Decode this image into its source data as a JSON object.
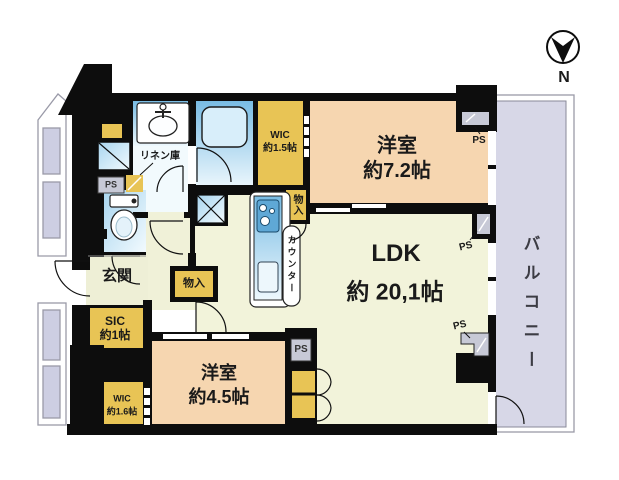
{
  "palette": {
    "wall": "#0d0d0d",
    "room_peach": "#f6d6b0",
    "floor_yellow_green": "#f2f3da",
    "closet_yellow": "#e8c455",
    "water_blue": "#79bce4",
    "balcony_lavender": "#d7d7e7",
    "ps_grey": "#c7c9d6"
  },
  "compass": {
    "north_label": "N"
  },
  "balcony": {
    "label": "バルコニー"
  },
  "rooms": {
    "bedroom_main": {
      "name": "洋室",
      "size": "約7.2帖"
    },
    "ldk": {
      "name": "LDK",
      "size": "約 20,1帖"
    },
    "bedroom_second": {
      "name": "洋室",
      "size": "約4.5帖"
    },
    "entrance": {
      "name": "玄関"
    },
    "shoe_closet": {
      "name": "SIC",
      "size": "約1帖"
    },
    "wic_main": {
      "name": "WIC",
      "size": "約1.5帖"
    },
    "wic_second": {
      "name": "WIC",
      "size": "約1.6帖"
    }
  },
  "fixtures": {
    "linen_closet": "リネン庫",
    "kitchen_counter": "カウンター",
    "storage": "物入",
    "pipe_space": "PS"
  }
}
